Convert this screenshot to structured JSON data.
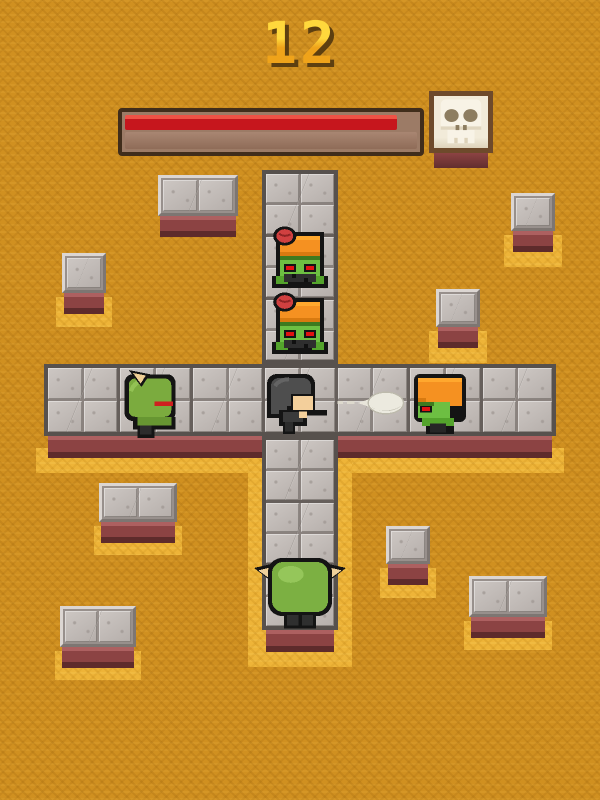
{
  "hud": {
    "score": "12",
    "health_bar": {
      "fill_percent": 93,
      "fill_color": "#c6161d",
      "icon": "skull"
    }
  },
  "entities": [
    {
      "id": "zombie-top-1",
      "kind": "zombie",
      "facing": "front",
      "features": [
        "orange-cap",
        "exposed-brain",
        "red-eyes"
      ]
    },
    {
      "id": "zombie-top-2",
      "kind": "zombie",
      "facing": "front",
      "features": [
        "orange-cap",
        "exposed-brain",
        "red-eyes"
      ]
    },
    {
      "id": "ogre-left",
      "kind": "horned-ogre",
      "facing": "right"
    },
    {
      "id": "player",
      "kind": "hero",
      "facing": "right",
      "weapon": "gun"
    },
    {
      "id": "bullet",
      "kind": "projectile",
      "direction": "right"
    },
    {
      "id": "zombie-right",
      "kind": "zombie",
      "facing": "left"
    },
    {
      "id": "ogre-boss-bottom",
      "kind": "horned-ogre-large",
      "facing": "up"
    }
  ],
  "board": {
    "layout": "cross-of-stone-tiles",
    "scattered_blocks": 8
  },
  "palette": {
    "background_orange": "#d09020",
    "sand_yellow": "#eeb438",
    "stone_gray": "#c3bcb8",
    "stone_border": "#57514d",
    "base_maroon": "#8c4343",
    "health_red": "#c6161d",
    "score_yellow": "#ffd12a",
    "zombie_green": "#6dbf42",
    "cap_orange": "#f59121",
    "ogre_green": "#7bab3e",
    "horn_tan": "#efcf96",
    "skull_cream": "#f2ebd9"
  }
}
